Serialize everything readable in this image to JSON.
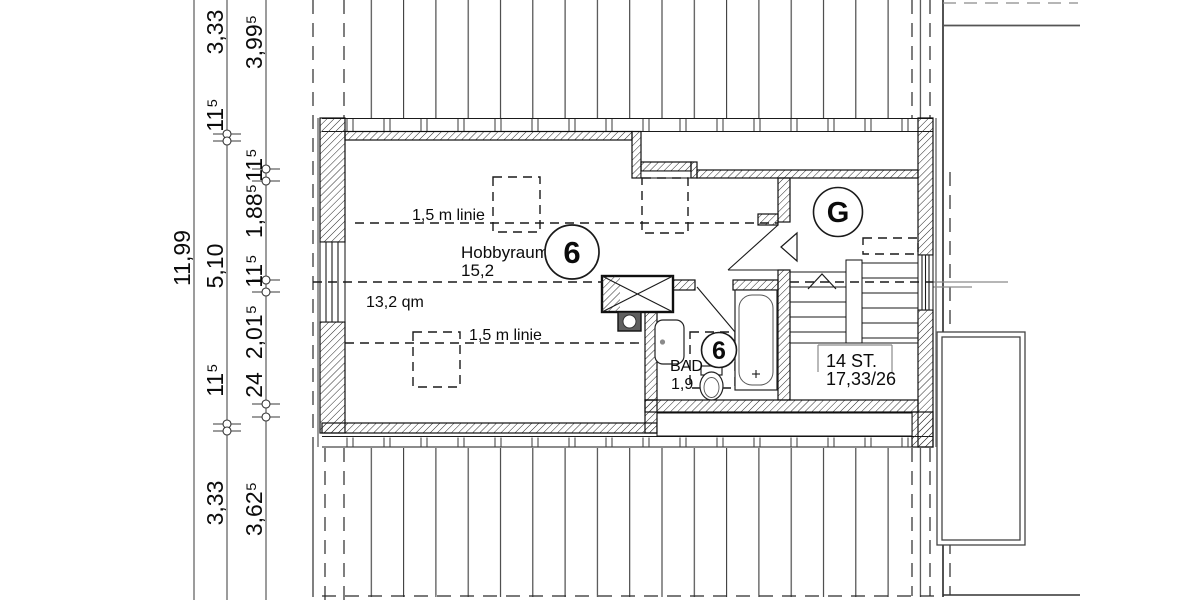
{
  "drawing": {
    "type": "floor-plan",
    "language": "de"
  },
  "dimensions": {
    "overall": "11,99",
    "chain_middle": [
      "3,33",
      "11⁵",
      "5,10",
      "11⁵",
      "3,33"
    ],
    "chain_inner": [
      "3,99⁵",
      "11⁵",
      "1,88⁵",
      "11⁵",
      "2,01⁵",
      "24",
      "3,62⁵"
    ]
  },
  "rooms": {
    "hobbyraum": {
      "name": "Hobbyraum",
      "value": "15,2",
      "area": "13,2 qm",
      "number": "6"
    },
    "bad": {
      "name": "BAD",
      "value": "1,9",
      "number": "6"
    },
    "gallery": {
      "letter": "G"
    }
  },
  "stairs": {
    "steps": "14 ST.",
    "ratio": "17,33/26"
  },
  "annotations": {
    "height_line_top": "1,5 m linie",
    "height_line_bottom": "1,5 m linie"
  },
  "colors": {
    "ink": "#111111",
    "paper": "#ffffff"
  }
}
